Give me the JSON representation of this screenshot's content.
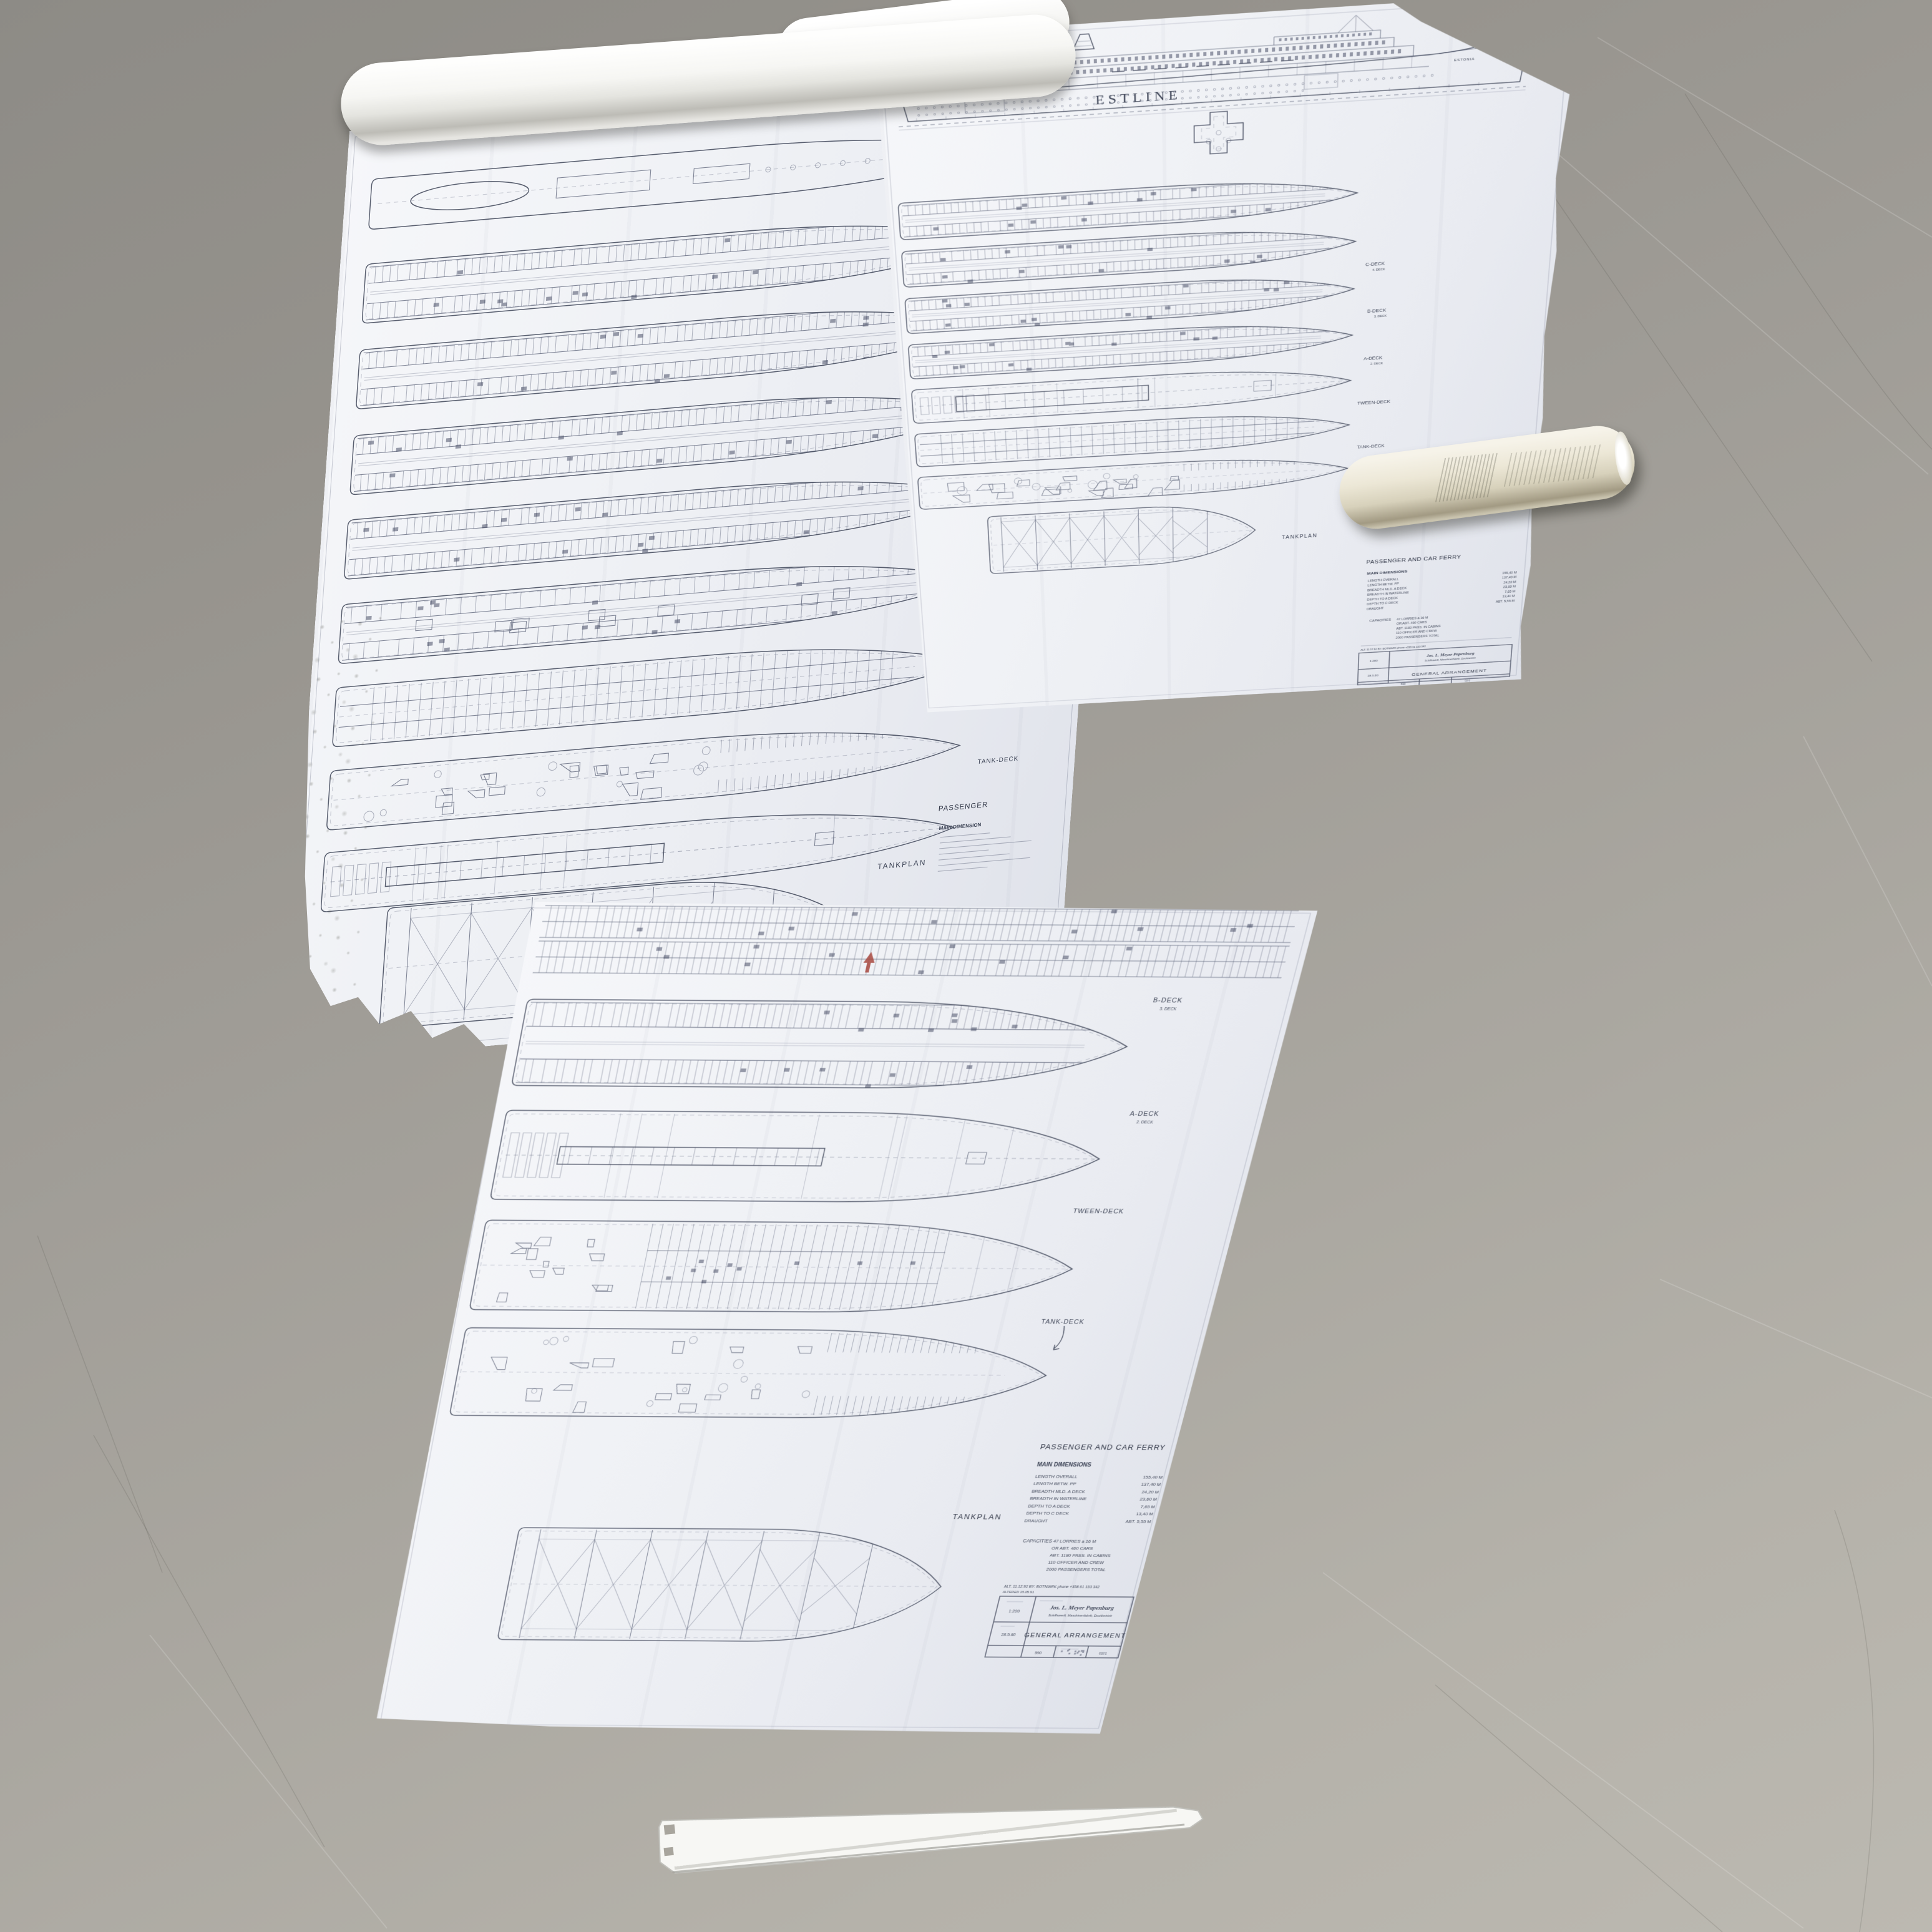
{
  "palette": {
    "floor": "#a4a19a",
    "paper": "#eef0f4",
    "ink": "#4b5268",
    "ink_dark": "#2f3545",
    "accent_red": "#a8493f",
    "roll_paper": "#e7e2d0"
  },
  "brand": {
    "line": "ESTLINE",
    "ship": "ESTONIA"
  },
  "decks": {
    "b": "B-DECK",
    "b_sub": "3. DECK",
    "a": "A-DECK",
    "a_sub": "2. DECK",
    "c": "C-DECK",
    "c_sub": "4. DECK",
    "tween": "TWEEN-DECK",
    "tank": "TANK-DECK",
    "tankplan": "TANKPLAN"
  },
  "left": {
    "passenger": "PASSENGER",
    "main_dim": "MAIN DIMENSION"
  },
  "info": {
    "heading": "PASSENGER AND CAR FERRY",
    "dim_title": "MAIN DIMENSIONS",
    "dims": [
      {
        "label": "LENGTH OVERALL",
        "value": "155,40 M"
      },
      {
        "label": "LENGTH BETW. PP",
        "value": "137,40 M"
      },
      {
        "label": "BREADTH MLD. A DECK",
        "value": "24,20 M"
      },
      {
        "label": "BREADTH IN WATERLINE",
        "value": "23,60 M"
      },
      {
        "label": "DEPTH TO A DECK",
        "value": "7,65 M"
      },
      {
        "label": "DEPTH TO C DECK",
        "value": "13,40 M"
      },
      {
        "label": "DRAUGHT",
        "value": "ABT. 5,55 M"
      }
    ],
    "cap_label": "CAPACITIES",
    "caps": [
      "47 LORRIES a 16 M",
      "OR ABT. 460 CARS",
      "ABT. 1180 PASS. IN CABINS",
      "110 OFFICER AND CREW",
      "2000 PASSENGERS TOTAL"
    ]
  },
  "title_block": {
    "alt_line": "ALT. 11.12.92   BY: BOTNIARK   phone +358 61 153 342",
    "altered_line": "ALTERED  15.05.91",
    "scale": "1:200",
    "date": "28.5.80",
    "company": "Jos. L. Meyer Papenburg",
    "company_sub": "Schiffswerft, Maschinenfabrik, Dockbetrieb",
    "title": "GENERAL ARRANGEMENT",
    "sheet_no": "590",
    "rev_no": "02/1"
  }
}
